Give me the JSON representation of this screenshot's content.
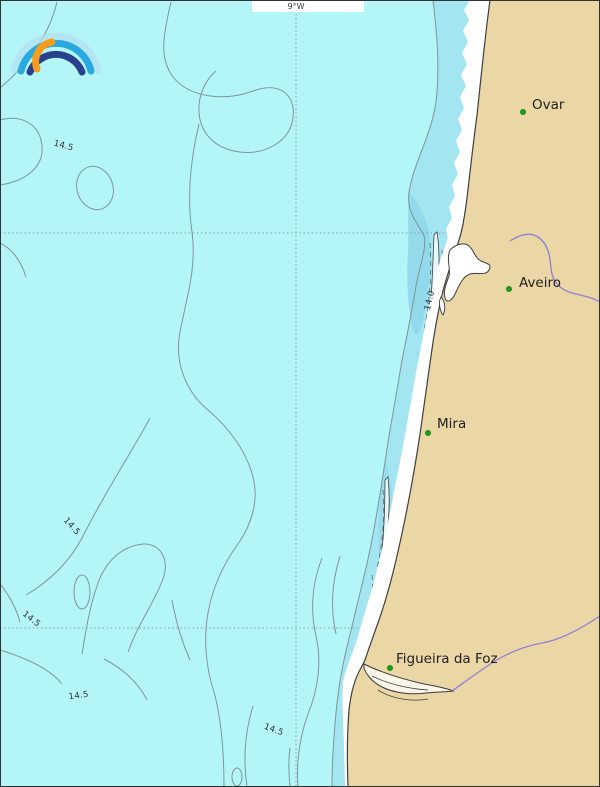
{
  "map": {
    "grid": {
      "longitude_label": "9°W"
    },
    "cities": [
      {
        "name": "Ovar"
      },
      {
        "name": "Aveiro"
      },
      {
        "name": "Mira"
      },
      {
        "name": "Figueira da Foz"
      }
    ],
    "contour_labels": [
      {
        "text": "14.5"
      },
      {
        "text": "14.0"
      },
      {
        "text": "14.5"
      },
      {
        "text": "14.5"
      },
      {
        "text": "14.5"
      },
      {
        "text": "14.5"
      }
    ],
    "colors": {
      "sea": "#b4f6f8",
      "nearshore_shallow": "#a3e6f2",
      "nearshore_deep_patch": "#8fd6ea",
      "beach": "#ffffff",
      "land": "#ead7a5",
      "coastline": "#3f3f3f",
      "depth_contour": "#7a9093",
      "river": "#8d7fd6",
      "city_marker": "#12a212",
      "graticule": "#9a9a9a"
    },
    "logo": {
      "description": "rainbow-arcs-logo",
      "arc_colors": [
        "#b3dff3",
        "#2aa9e0",
        "#27418f",
        "#f89c1d"
      ]
    }
  }
}
